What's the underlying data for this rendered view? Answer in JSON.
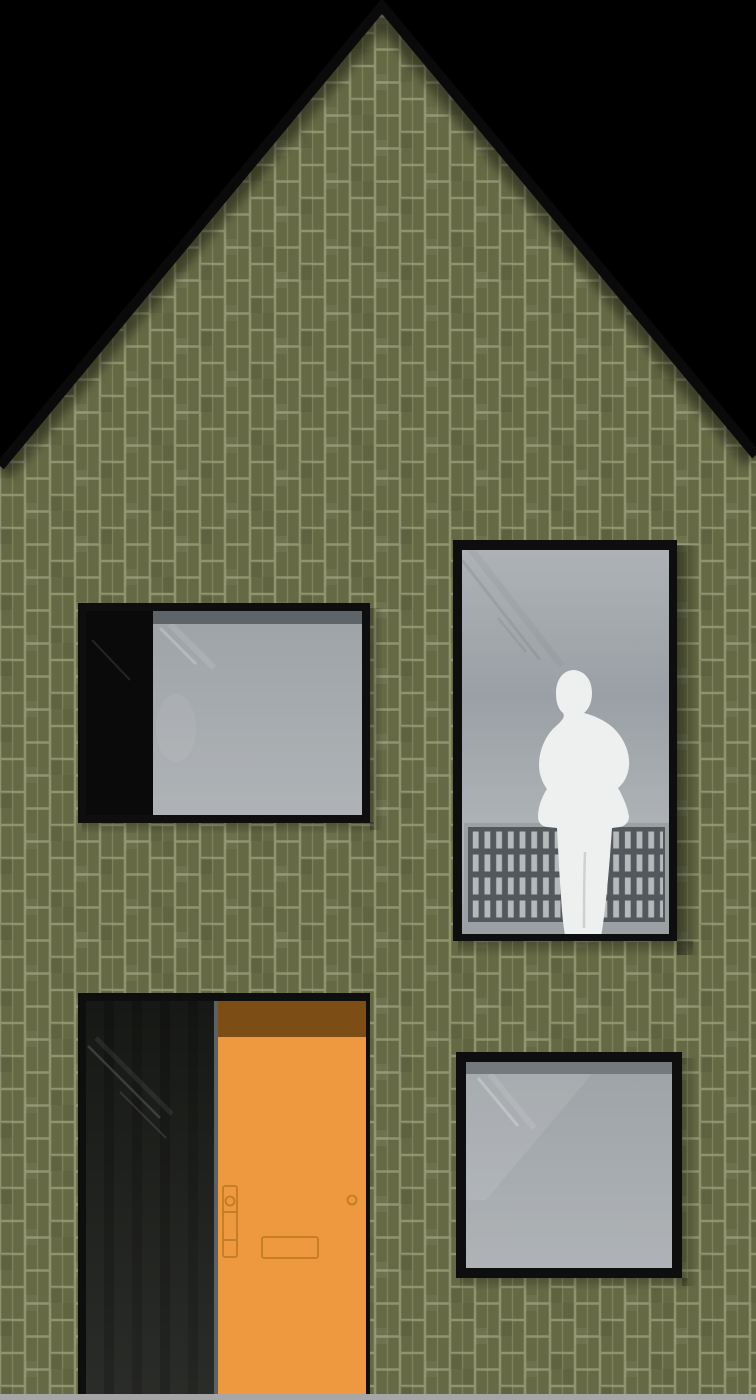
{
  "scene": {
    "subject": "gabled-house-front-elevation",
    "cladding": "stacked-bond green brick",
    "railing_rows": 4,
    "person_present": true
  },
  "colors": {
    "background": "#000000",
    "brick": "#666a44",
    "mortar": "#9a9d78",
    "roof_edge": "#0a0a0a",
    "window_frame": "#0e0e0e",
    "panel_black": "#0a0a0a",
    "vent_strip": "#5f6468",
    "vent_strip_square": "#74797d",
    "glass_top": "#aeb2b6",
    "glass_mid": "#9aa0a5",
    "glass_bottom": "#b2b6b9",
    "glass_small_top": "#9fa4a8",
    "glass_small_bottom": "#afb3b6",
    "railing_frame": "#9ba0a2",
    "railing_panel": "#53585c",
    "railing_slat": "#b5b9bb",
    "person": "#eef0f0",
    "person_crease": "#c6c9c9",
    "door": "#ee9940",
    "door_band": "#7c4e16",
    "door_hardware": "#c17b27",
    "door_glass_top": "#161815",
    "door_glass_bottom": "#2a2c29",
    "door_jamb": "#5e6164",
    "ground": "#a6a6a6"
  }
}
